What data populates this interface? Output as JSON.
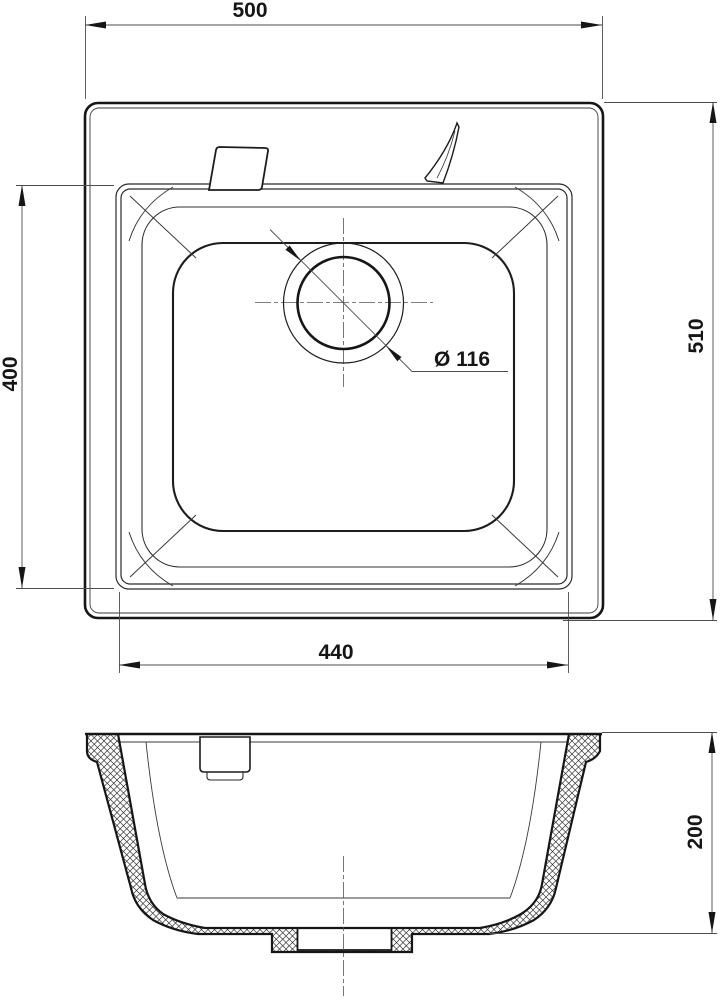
{
  "dimensions": {
    "overall_width": "500",
    "overall_depth": "510",
    "bowl_length": "400",
    "bowl_width": "440",
    "drain_diameter": "Ø 116",
    "bowl_height": "200"
  },
  "colors": {
    "object_line": "#161616",
    "dimension_line": "#4d4d4d",
    "background": "#ffffff"
  }
}
